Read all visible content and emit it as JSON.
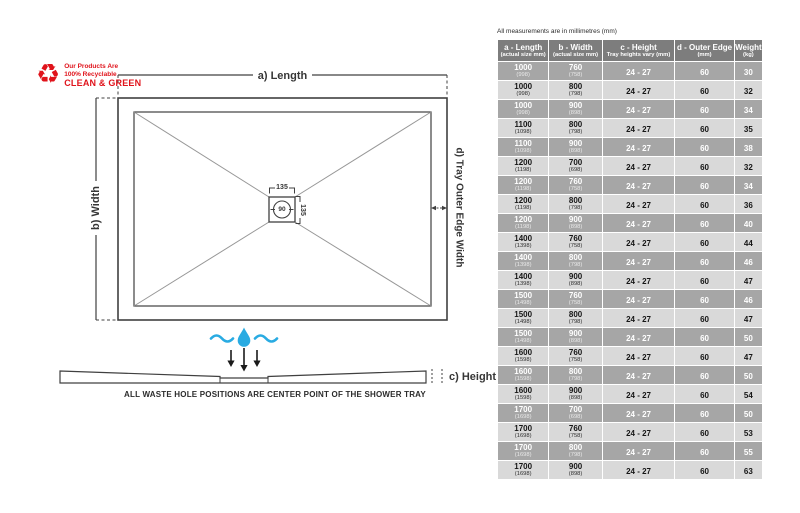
{
  "eco": {
    "recycle_icon": "♻",
    "line1": "Our Products Are",
    "line2": "100% Recyclable",
    "line3": "CLEAN & GREEN",
    "color": "#e0131b"
  },
  "diagram": {
    "length_label": "a) Length",
    "width_label": "b) Width",
    "outer_edge_label": "d) Tray Outer Edge Width",
    "height_label": "c) Height",
    "waste_width": "135",
    "waste_depth": "135",
    "waste_diameter": "90",
    "caption": "ALL WASTE HOLE POSITIONS ARE CENTER POINT OF THE SHOWER TRAY",
    "line_color": "#404040",
    "water_color": "#29abe2"
  },
  "table": {
    "note": "All measurements are in millimetres (mm)",
    "header": [
      {
        "main": "a - Length",
        "sub": "(actual size mm)"
      },
      {
        "main": "b - Width",
        "sub": "(actual size mm)"
      },
      {
        "main": "c - Height",
        "sub": "Tray heights vary (mm)"
      },
      {
        "main": "d - Outer Edge",
        "sub": "(mm)"
      },
      {
        "main": "Weight",
        "sub": "(kg)"
      }
    ],
    "colors": {
      "header_bg": "#7d7d7d",
      "dark_row_bg": "#a6a6a6",
      "light_row_bg": "#d9d9d9"
    },
    "rows": [
      {
        "length": "1000",
        "length_actual": "(998)",
        "width": "760",
        "width_actual": "(758)",
        "height": "24 - 27",
        "outer_edge": "60",
        "weight": "30"
      },
      {
        "length": "1000",
        "length_actual": "(998)",
        "width": "800",
        "width_actual": "(798)",
        "height": "24 - 27",
        "outer_edge": "60",
        "weight": "32"
      },
      {
        "length": "1000",
        "length_actual": "(998)",
        "width": "900",
        "width_actual": "(898)",
        "height": "24 - 27",
        "outer_edge": "60",
        "weight": "34"
      },
      {
        "length": "1100",
        "length_actual": "(1098)",
        "width": "800",
        "width_actual": "(798)",
        "height": "24 - 27",
        "outer_edge": "60",
        "weight": "35"
      },
      {
        "length": "1100",
        "length_actual": "(1098)",
        "width": "900",
        "width_actual": "(898)",
        "height": "24 - 27",
        "outer_edge": "60",
        "weight": "38"
      },
      {
        "length": "1200",
        "length_actual": "(1198)",
        "width": "700",
        "width_actual": "(698)",
        "height": "24 - 27",
        "outer_edge": "60",
        "weight": "32"
      },
      {
        "length": "1200",
        "length_actual": "(1198)",
        "width": "760",
        "width_actual": "(758)",
        "height": "24 - 27",
        "outer_edge": "60",
        "weight": "34"
      },
      {
        "length": "1200",
        "length_actual": "(1198)",
        "width": "800",
        "width_actual": "(798)",
        "height": "24 - 27",
        "outer_edge": "60",
        "weight": "36"
      },
      {
        "length": "1200",
        "length_actual": "(1198)",
        "width": "900",
        "width_actual": "(898)",
        "height": "24 - 27",
        "outer_edge": "60",
        "weight": "40"
      },
      {
        "length": "1400",
        "length_actual": "(1398)",
        "width": "760",
        "width_actual": "(758)",
        "height": "24 - 27",
        "outer_edge": "60",
        "weight": "44"
      },
      {
        "length": "1400",
        "length_actual": "(1398)",
        "width": "800",
        "width_actual": "(798)",
        "height": "24 - 27",
        "outer_edge": "60",
        "weight": "46"
      },
      {
        "length": "1400",
        "length_actual": "(1398)",
        "width": "900",
        "width_actual": "(898)",
        "height": "24 - 27",
        "outer_edge": "60",
        "weight": "47"
      },
      {
        "length": "1500",
        "length_actual": "(1498)",
        "width": "760",
        "width_actual": "(758)",
        "height": "24 - 27",
        "outer_edge": "60",
        "weight": "46"
      },
      {
        "length": "1500",
        "length_actual": "(1498)",
        "width": "800",
        "width_actual": "(798)",
        "height": "24 - 27",
        "outer_edge": "60",
        "weight": "47"
      },
      {
        "length": "1500",
        "length_actual": "(1498)",
        "width": "900",
        "width_actual": "(898)",
        "height": "24 - 27",
        "outer_edge": "60",
        "weight": "50"
      },
      {
        "length": "1600",
        "length_actual": "(1598)",
        "width": "760",
        "width_actual": "(758)",
        "height": "24 - 27",
        "outer_edge": "60",
        "weight": "47"
      },
      {
        "length": "1600",
        "length_actual": "(1598)",
        "width": "800",
        "width_actual": "(798)",
        "height": "24 - 27",
        "outer_edge": "60",
        "weight": "50"
      },
      {
        "length": "1600",
        "length_actual": "(1598)",
        "width": "900",
        "width_actual": "(898)",
        "height": "24 - 27",
        "outer_edge": "60",
        "weight": "54"
      },
      {
        "length": "1700",
        "length_actual": "(1698)",
        "width": "700",
        "width_actual": "(698)",
        "height": "24 - 27",
        "outer_edge": "60",
        "weight": "50"
      },
      {
        "length": "1700",
        "length_actual": "(1698)",
        "width": "760",
        "width_actual": "(758)",
        "height": "24 - 27",
        "outer_edge": "60",
        "weight": "53"
      },
      {
        "length": "1700",
        "length_actual": "(1698)",
        "width": "800",
        "width_actual": "(798)",
        "height": "24 - 27",
        "outer_edge": "60",
        "weight": "55"
      },
      {
        "length": "1700",
        "length_actual": "(1698)",
        "width": "900",
        "width_actual": "(898)",
        "height": "24 - 27",
        "outer_edge": "60",
        "weight": "63"
      }
    ]
  }
}
